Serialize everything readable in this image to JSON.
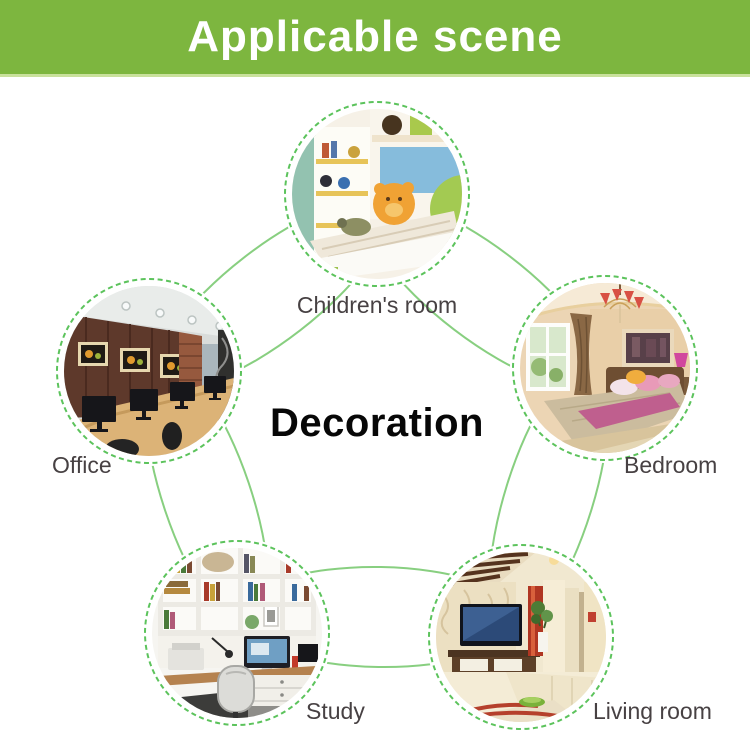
{
  "header": {
    "title": "Applicable scene",
    "bg_color": "#7db63f",
    "text_color": "#ffffff"
  },
  "diagram": {
    "center_label": "Decoration",
    "scenes": [
      {
        "id": "children-room",
        "label": "Children's room",
        "position": "top"
      },
      {
        "id": "bedroom",
        "label": "Bedroom",
        "position": "right"
      },
      {
        "id": "living-room",
        "label": "Living room",
        "position": "bottom-right"
      },
      {
        "id": "study",
        "label": "Study",
        "position": "bottom-left"
      },
      {
        "id": "office",
        "label": "Office",
        "position": "left"
      }
    ]
  },
  "colors": {
    "connector_green": "#88cf80",
    "dashed_ring_green": "#5cc35c",
    "label_gray": "#474143",
    "center_text": "#070707"
  }
}
